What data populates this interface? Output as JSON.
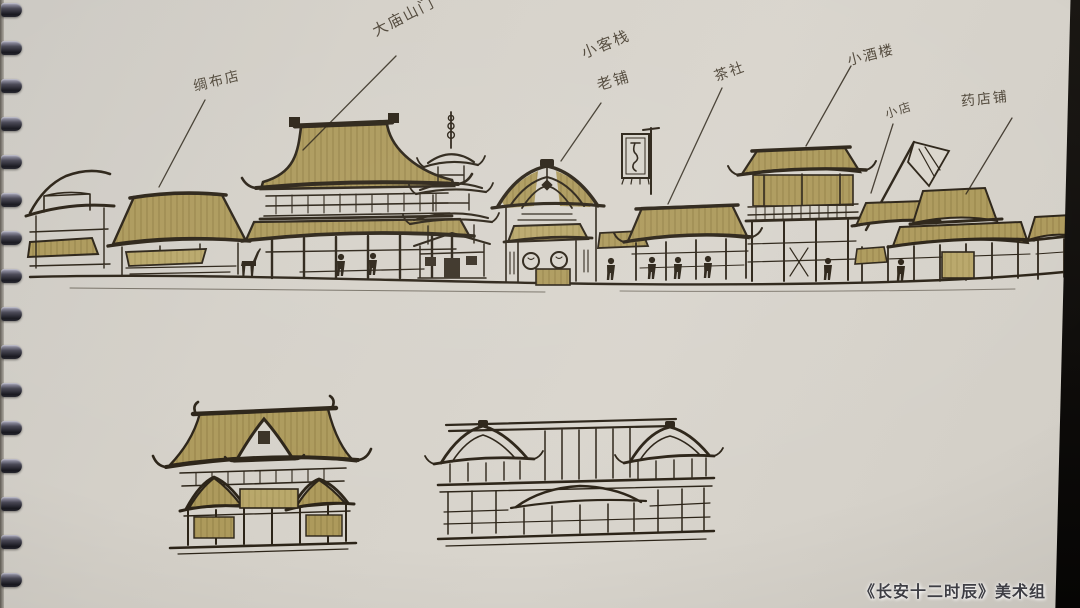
{
  "photo": {
    "caption": "《长安十二时辰》美术组"
  },
  "sketch": {
    "labels": [
      {
        "id": "silk-cloth-shop",
        "text": "绸布店"
      },
      {
        "id": "temple-gate",
        "text": "大庙山门"
      },
      {
        "id": "small-inn",
        "text": "小客栈"
      },
      {
        "id": "old-shop",
        "text": "老铺"
      },
      {
        "id": "teahouse",
        "text": "茶社"
      },
      {
        "id": "wine-tower",
        "text": "小酒楼"
      },
      {
        "id": "small-shop",
        "text": "小店"
      },
      {
        "id": "pharmacy-shop",
        "text": "药店铺"
      }
    ],
    "colors": {
      "paper": "#d6d2ca",
      "ink": "#2c2418",
      "roof_tan": "#ab9657",
      "binding_dark": "#1a1a20"
    }
  }
}
